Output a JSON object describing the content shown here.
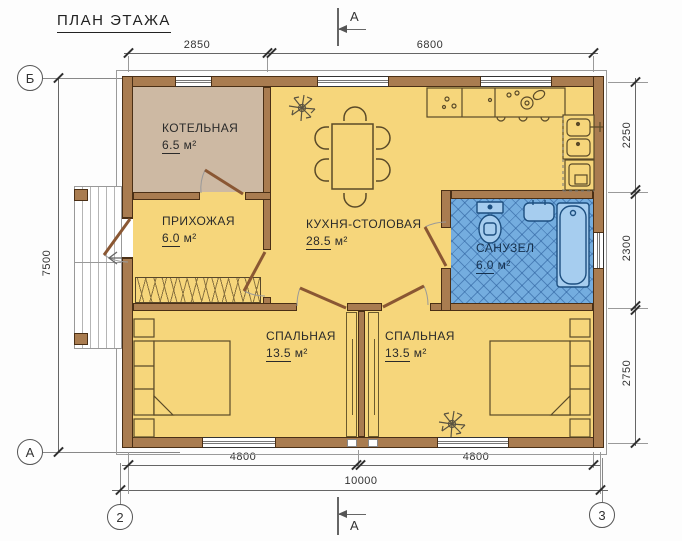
{
  "title": "ПЛАН ЭТАЖА",
  "rooms": [
    {
      "name": "КОТЕЛЬНАЯ",
      "area": "6.5",
      "unit": "м²"
    },
    {
      "name": "ПРИХОЖАЯ",
      "area": "6.0",
      "unit": "м²"
    },
    {
      "name": "КУХНЯ-СТОЛОВАЯ",
      "area": "28.5",
      "unit": "м²"
    },
    {
      "name": "САНУЗЕЛ",
      "area": "6.0",
      "unit": "м²"
    },
    {
      "name": "СПАЛЬНАЯ",
      "area": "13.5",
      "unit": "м²"
    },
    {
      "name": "СПАЛЬНАЯ",
      "area": "13.5",
      "unit": "м²"
    }
  ],
  "dimensions": {
    "top": [
      "2850",
      "6800"
    ],
    "right": [
      "2250",
      "2300",
      "2750"
    ],
    "bottom": [
      "4800",
      "4800"
    ],
    "bottom_total": "10000",
    "left": "7500"
  },
  "axes": {
    "row_top": "Б",
    "row_bottom": "А",
    "col_left": "2",
    "col_right": "3"
  },
  "section": {
    "label": "А"
  },
  "colors": {
    "wall": "#A97C50",
    "wall_outline": "#4A2F15",
    "floor_yellow": "#F6D67B",
    "boiler_tan": "#CDB9A3",
    "bath_blue": "#74ADDF",
    "bath_grid": "#4C86BC",
    "door_leaf": "#8A5733"
  }
}
